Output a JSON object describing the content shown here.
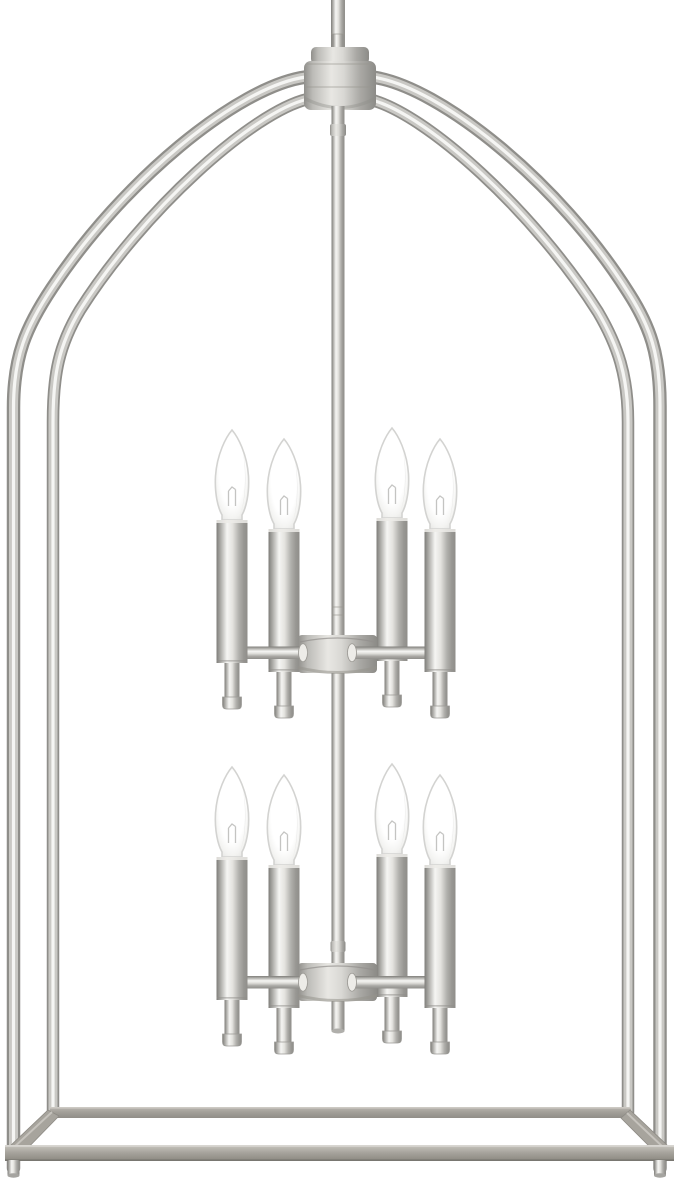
{
  "image": {
    "type": "product-photo",
    "subject": "8-light two-tier lantern chandelier pendant, brushed nickel finish, on white background",
    "background_color": "#ffffff"
  },
  "product": {
    "fixture_style": "open lantern cage pendant",
    "finish_name": "brushed nickel",
    "tiers": 2,
    "lights_per_tier": 4,
    "total_lights": 8,
    "bulb_style": "candelabra flame bulb, lit white",
    "frame": {
      "posts": 4,
      "top_shape": "four curved arms meeting at center canopy hub",
      "base_shape": "open rectangular bottom frame with feet on front posts"
    }
  },
  "palette": {
    "metal_edge": "#8f8e8a",
    "metal_dark": "#7e7d79",
    "metal_mid": "#c9c8c4",
    "metal_highlight": "#f5f5f3",
    "rail_top": "#ccc9c3",
    "rail_mid": "#a5a29b",
    "rail_dark": "#8b8880",
    "bulb_outline": "#d3d3d1",
    "bulb_glow": "#ffffff",
    "filament": "#c4c4c2",
    "bg": "#ffffff"
  }
}
